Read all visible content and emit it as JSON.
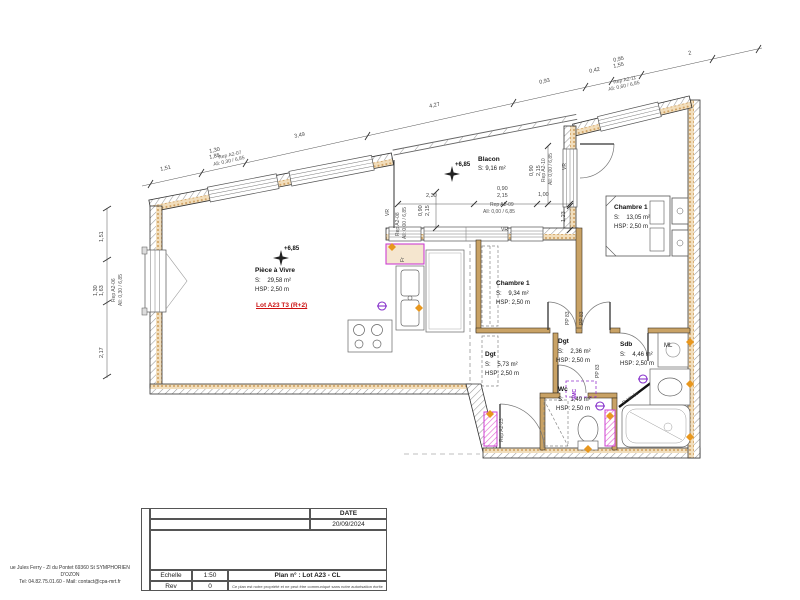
{
  "title_block": {
    "date_label": "DATE",
    "date_value": "20/09/2024",
    "scale_label": "Echelle",
    "scale_value": "1:50",
    "plan_label": "Plan n° : Lot A23 - CL",
    "rev_label": "Rev",
    "rev_value": "0",
    "disclaimer": "Ce plan est notre propriété et ne peut être communiqué sans notre autorisation écrite",
    "address_line1": "ue Jules Ferry - ZI du Pontet 69360 St SYMPHORIEN D'OZON",
    "address_line2": "Tel: 04.82.75.01.60 - Mail: contact@cpa-mrt.fr"
  },
  "lot_label": "Lot A23 T3 (R+2)",
  "levels": {
    "living": "+6,85",
    "balcony": "+6,85"
  },
  "rooms": [
    {
      "name": "Pièce à Vivre",
      "area": "S:    29,58 m²",
      "hsp": "HSP: 2,50 m"
    },
    {
      "name": "Blacon",
      "area": "S: 9,16 m²"
    },
    {
      "name": "Chambre 1",
      "area": "S:    9,34 m²",
      "hsp": "HSP: 2,50 m"
    },
    {
      "name": "Chambre 1",
      "area": "S:    13,05 m²",
      "hsp": "HSP: 2,50 m"
    },
    {
      "name": "Dgt",
      "area": "S:    5,73 m²",
      "hsp": "HSP: 2,50 m"
    },
    {
      "name": "Dgt",
      "area": "S:    2,36 m²",
      "hsp": "HSP: 2,50 m"
    },
    {
      "name": "Sdb",
      "area": "S:    4,46 m²",
      "hsp": "HSP: 2,50 m"
    },
    {
      "name": "Wc",
      "area": "S:    1,49 m²",
      "hsp": "HSP: 2,50 m"
    }
  ],
  "annotations": {
    "vr": "VR",
    "pp83": "PP 83",
    "ml": "ML",
    "fr": "Fr",
    "vmc": "VMC",
    "p_vitree": "P. Vitrée",
    "rep_entry": "Rep A2-23"
  },
  "reps": [
    {
      "id": "Rep A2-06",
      "all": "All: 0,30 / 6,85"
    },
    {
      "id": "Rep A2-07",
      "all": "All: 0,30 / 6,85"
    },
    {
      "id": "Rep A2-08",
      "all": "All: 0,00 / 6,85"
    },
    {
      "id": "Rep A2-09",
      "all": "All: 0,00 / 6,85"
    },
    {
      "id": "Rep A2-10",
      "all": "All: 0,00 / 6,85"
    },
    {
      "id": "Rep A2-11",
      "all": "All: 0,60 / 6,85"
    }
  ],
  "dims": {
    "top": [
      "1,51",
      "1,30",
      "1,85",
      "3,49",
      "4,27",
      "0,93",
      "0,42",
      "0,95",
      "1,55",
      "2"
    ],
    "left": [
      "1,51",
      "1,30",
      "1,63",
      "2,17"
    ],
    "balcony": [
      "2,30",
      "0,90",
      "2,15",
      "1,00",
      "1,23"
    ],
    "balcony_left": [
      "0,90",
      "2,15"
    ],
    "balcony_right": [
      "0,90",
      "2,15"
    ]
  },
  "colors": {
    "wall_hatch": "#999999",
    "insulation": "#cf9f5e",
    "partition": "#c9a265",
    "accent_magenta": "#cc3fd1",
    "accent_purple": "#9333cc",
    "accent_orange": "#e8971e",
    "lot_red": "#cc1111"
  }
}
